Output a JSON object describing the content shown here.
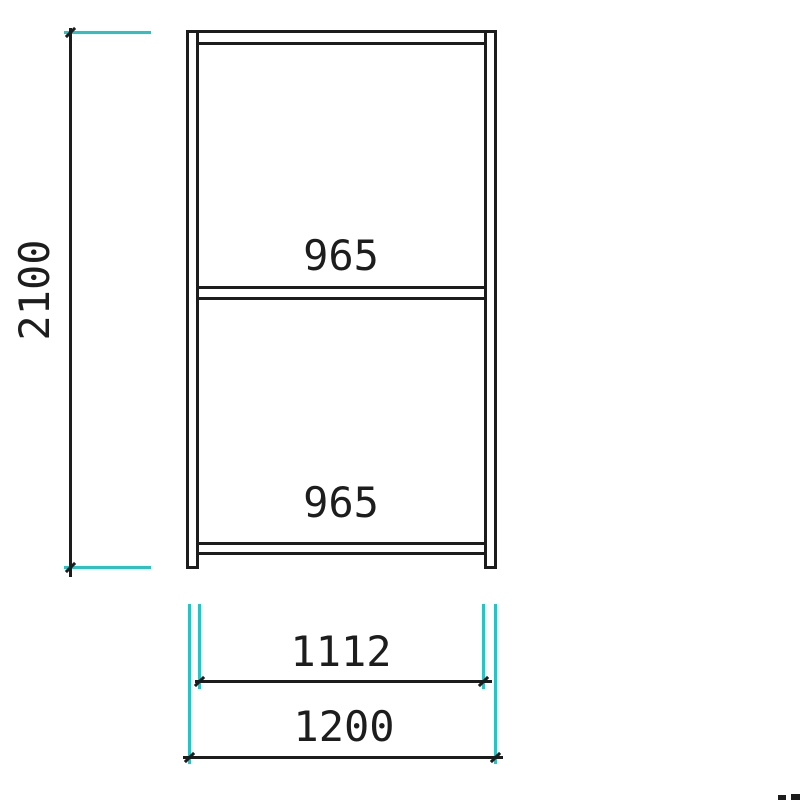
{
  "drawing": {
    "labels": {
      "height": "2100",
      "upper_shelf_span": "965",
      "lower_shelf_span": "965",
      "inner_width": "1112",
      "outer_width": "1200"
    },
    "colors": {
      "line": "#1c1c1c",
      "extension": "#26c4c4",
      "background": "#ffffff"
    }
  }
}
